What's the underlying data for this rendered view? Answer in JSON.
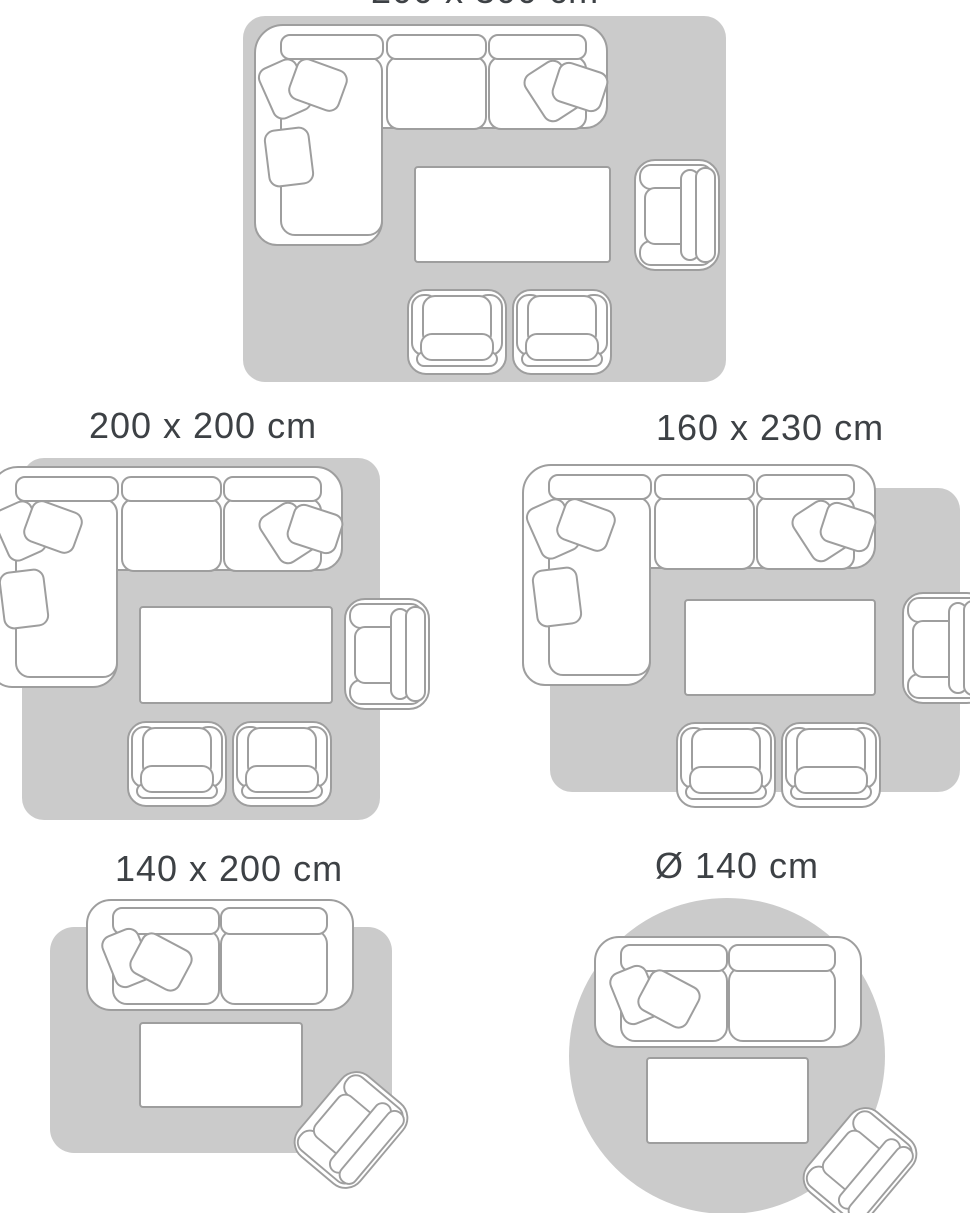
{
  "page": {
    "kind": "rug-size-guide"
  },
  "colors": {
    "background": "#ffffff",
    "rug": "#cbcbcb",
    "furniture_fill": "#ffffff",
    "furniture_outline": "#9e9e9e",
    "title_text": "#3d4145"
  },
  "size_guide": {
    "diagrams": [
      {
        "title": "200 x 300 cm",
        "rug_shape": "rectangle",
        "furniture": [
          "corner-sofa",
          "coffee-table",
          "armchair",
          "armchair",
          "armchair"
        ]
      },
      {
        "title": "200 x 200 cm",
        "rug_shape": "square",
        "furniture": [
          "corner-sofa",
          "coffee-table",
          "armchair",
          "armchair",
          "armchair"
        ]
      },
      {
        "title": "160 x 230 cm",
        "rug_shape": "rectangle",
        "furniture": [
          "corner-sofa",
          "coffee-table",
          "armchair",
          "armchair",
          "armchair"
        ]
      },
      {
        "title": "140 x 200 cm",
        "rug_shape": "rectangle",
        "furniture": [
          "two-seater-sofa",
          "coffee-table",
          "armchair"
        ]
      },
      {
        "title": "Ø 140 cm",
        "rug_shape": "circle",
        "furniture": [
          "two-seater-sofa",
          "coffee-table",
          "armchair"
        ]
      }
    ]
  }
}
